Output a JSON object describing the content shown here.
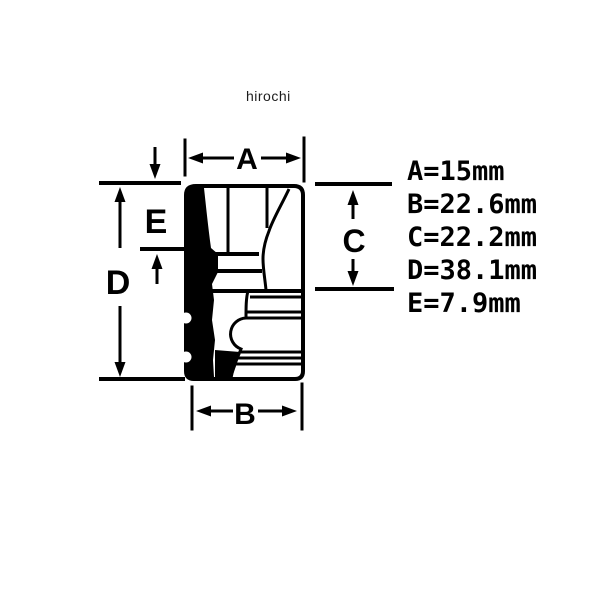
{
  "watermark": "hirochi",
  "drawing": {
    "description": "socket-wrench-dimension-diagram",
    "dim_labels": {
      "a": "A",
      "b": "B",
      "c": "C",
      "d": "D",
      "e": "E"
    }
  },
  "specs": [
    {
      "name": "A",
      "value": 15,
      "unit": "mm",
      "text": "A=15mm"
    },
    {
      "name": "B",
      "value": 22.6,
      "unit": "mm",
      "text": "B=22.6mm"
    },
    {
      "name": "C",
      "value": 22.2,
      "unit": "mm",
      "text": "C=22.2mm"
    },
    {
      "name": "D",
      "value": 38.1,
      "unit": "mm",
      "text": "D=38.1mm"
    },
    {
      "name": "E",
      "value": 7.9,
      "unit": "mm",
      "text": "E=7.9mm"
    }
  ],
  "colors": {
    "ink": "#000000",
    "background": "#ffffff",
    "watermark_ink": "#1c1c1c"
  }
}
